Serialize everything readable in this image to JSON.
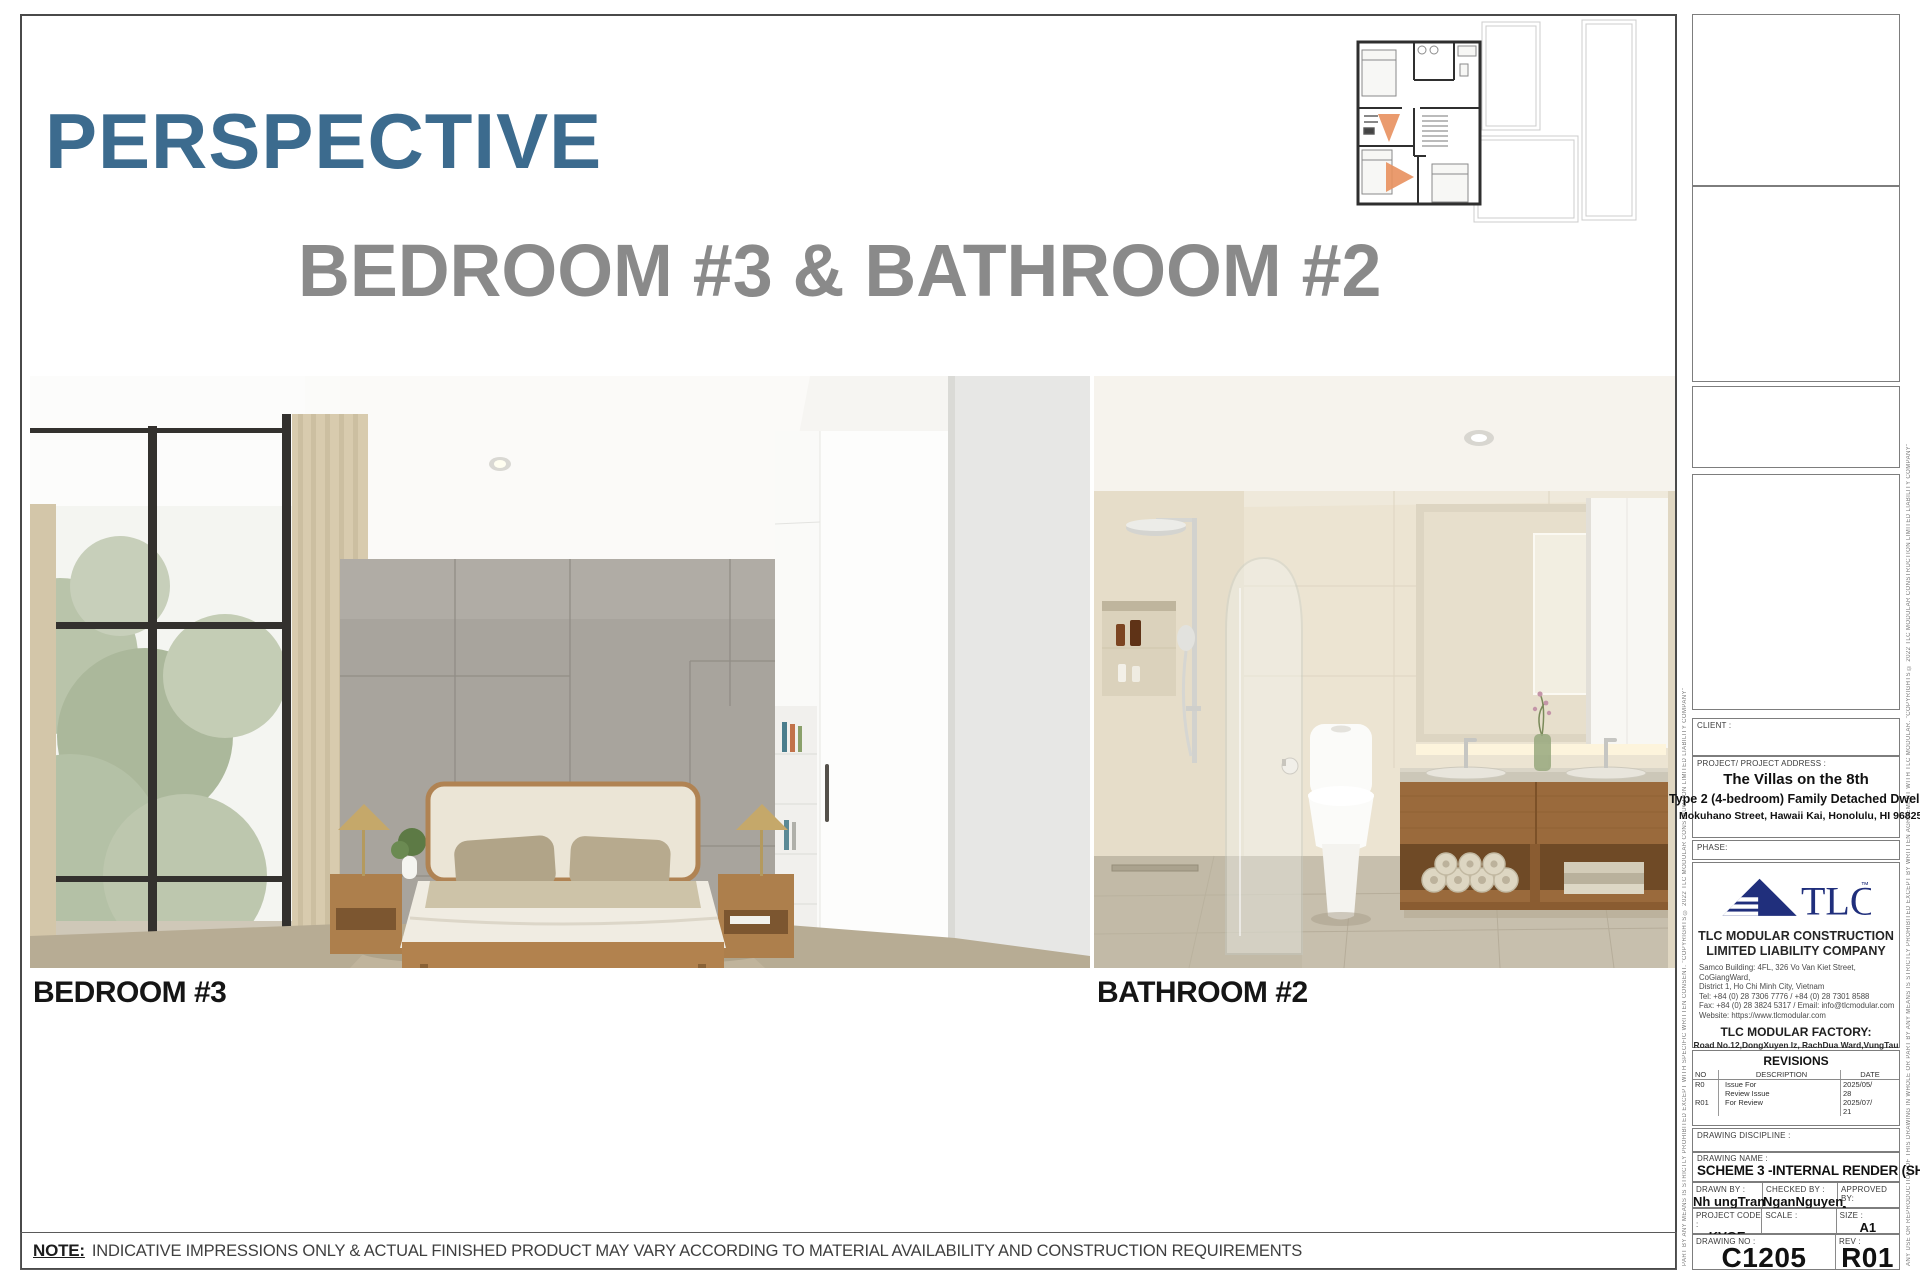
{
  "colors": {
    "accent_title": "#3c6b8e",
    "subtitle_gray": "#8a8a8a",
    "logo_navy": "#202f7c",
    "plan_cone": "#e8905e"
  },
  "page": {
    "title": "PERSPECTIVE",
    "subtitle": "BEDROOM #3 & BATHROOM #2",
    "note_label": "NOTE:",
    "note_text": "INDICATIVE IMPRESSIONS ONLY & ACTUAL FINISHED PRODUCT MAY VARY ACCORDING TO MATERIAL AVAILABILITY AND CONSTRUCTION REQUIREMENTS"
  },
  "renders": {
    "bedroom_label": "BEDROOM #3",
    "bathroom_label": "BATHROOM #2"
  },
  "edge_text": {
    "left": "PART BY ANY MEANS IS STRICTLY PROHIBITED EXCEPT WITH SPECIFIC WRITTEN CONSENT.  \"COPYRIGHTS © 2022 TLC MODULAR CONSTRUCTION LIMITED LIABILITY COMPANY\"",
    "right": "ANY USE OR REPRODUCTION OF THIS DRAWING IN WHOLE OR PART BY ANY MEANS IS STRICTLY PROHIBITED EXCEPT BY WRITTEN AGREEMENT WITH TLC MODULAR.  \"COPYRIGHTS © 2022 TLC MODULAR CONSTRUCTION LIMITED LIABILITY COMPANY\""
  },
  "titleblock": {
    "client_label": "CLIENT :",
    "project_label": "PROJECT/ PROJECT ADDRESS :",
    "project_name": "The Villas on the 8th",
    "project_type": "Type 2 (4-bedroom) Family Detached Dwelling",
    "project_address": "Mokuhano Street, Hawaii Kai, Honolulu, HI 96825",
    "phase_label": "PHASE:",
    "company": {
      "logo_text": "TLC",
      "logo_tm": "™",
      "name_line1": "TLC MODULAR CONSTRUCTION",
      "name_line2": "LIMITED LIABILITY COMPANY",
      "address_line1": "Samco Building: 4FL, 326 Vo Van Kiet Street, CoGiangWard,",
      "address_line2": "District 1, Ho Chi Minh City, Vietnam",
      "tel": "Tel:   +84 (0) 28 7306 7776 / +84 (0) 28 7301 8588",
      "fax": "Fax: +84 (0) 28 3824 5317 / Email: info@tlcmodular.com",
      "website": "Website: https://www.tlcmodular.com",
      "factory_heading": "TLC MODULAR FACTORY:",
      "factory_line1": "Road No.12,DongXuyen Iz, RachDua Ward,VungTau City,",
      "factory_line2": "Ba Ria-Vung Tau Province, Vietnam"
    },
    "revisions": {
      "heading": "REVISIONS",
      "col_no": "NO",
      "col_description": "DESCRIPTION",
      "col_date": "DATE",
      "rows": [
        {
          "no": "R0",
          "description": "Issue For",
          "date": "2025/05/"
        },
        {
          "no": "",
          "description": "Review Issue",
          "date": "28"
        },
        {
          "no": "R01",
          "description": "For Review",
          "date": "2025/07/"
        },
        {
          "no": "",
          "description": "",
          "date": "21"
        }
      ]
    },
    "discipline_label": "DRAWING DISCIPLINE :",
    "drawing_name_label": "DRAWING NAME :",
    "drawing_name": "SCHEME 3 -INTERNAL RENDER (SHEET 5)",
    "drawn_by_label": "DRAWN BY :",
    "drawn_by": "Nh ungTran",
    "checked_by_label": "CHECKED BY :",
    "checked_by": "NganNguyen",
    "approved_by_label": "APPROVED BY:",
    "approved_by": "Approver",
    "project_code_label": "PROJECT CODE :",
    "project_code": "KVGE",
    "scale_label": "SCALE :",
    "scale": "",
    "size_label": "SIZE :",
    "size": "A1",
    "drawing_no_label": "DRAWING NO :",
    "drawing_no": "C1205",
    "rev_label": "REV :",
    "rev": "R01"
  }
}
